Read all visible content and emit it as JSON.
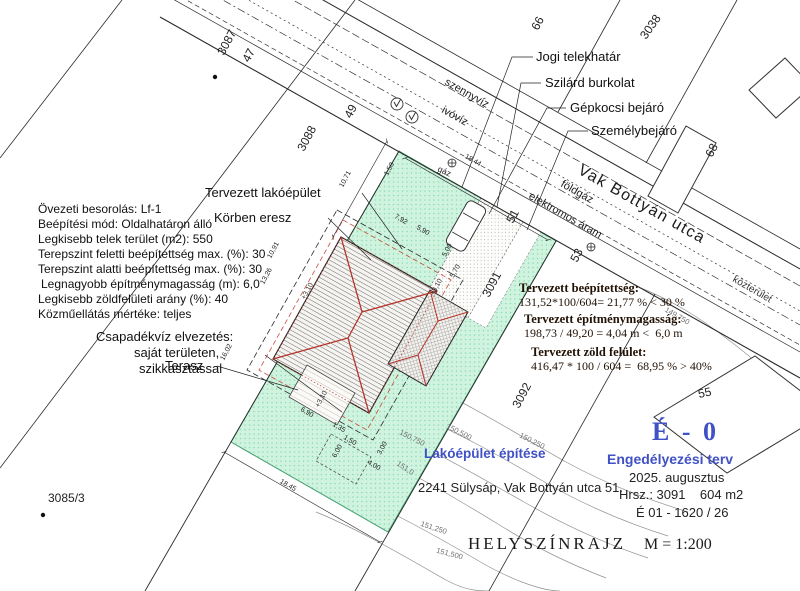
{
  "colors": {
    "plot_green": "#cff3de",
    "green_dot": "#8adbb0",
    "ridge_red": "#b5332a",
    "accent_blue": "#3f51c4",
    "date_blue": "#7c8ce0",
    "ink": "#1c1c1c"
  },
  "street": {
    "name": "Vak Bottyán utca",
    "kozterulet": "közterület"
  },
  "utilities": {
    "szennyviz": "szennyvíz",
    "ivoviz": "ivóvíz",
    "foldgaz": "földgáz",
    "elektromos": "elektromos áram",
    "gaz": "gáz"
  },
  "legend_leaders": {
    "jogi": "Jogi telekhatár",
    "szilard": "Szilárd burkolat",
    "gepkocsi": "Gépkocsi bejáró",
    "szemely": "Személybejáró"
  },
  "zoning_lines": [
    "Övezeti besorolás:  Lf-1",
    "Beépítési mód: Oldalhatáron álló",
    "Legkisebb telek terület (m2): 550",
    "Terepszint feletti beépítettség max. (%): 30",
    "Terepszint alatti beépítettség max. (%): 30",
    "Legnagyobb építménymagasság (m): 6,0",
    "Legkisebb zöldfelületi arány (%): 40",
    "Közműellátás mértéke: teljes"
  ],
  "drainage": {
    "l1": "Csapadékvíz elvezetés:",
    "l2": "saját területen,",
    "l3": "szikkasztással"
  },
  "house": {
    "lakoepulet": "Tervezett lakóépület",
    "eresz": "Körben eresz",
    "terasz": "Terasz"
  },
  "calc": {
    "t1": "Tervezett beépítettség:",
    "v1": "131,52*100/604= 21,77 % < 30 %",
    "t2": "Tervezett építménymagasság:",
    "v2": "198,73 / 49,20 = 4,04 m <  6,0 m",
    "t3": "Tervezett zöld felület:",
    "v3": "416,47 * 100 / 604 =  68,95 % > 40%"
  },
  "title_block": {
    "sheet": "É - 0",
    "project": "Lakóépület építése",
    "address": "2241 Sülysáp, Vak Bottyán utca 51.",
    "doc": "Engedélyezési terv",
    "date": "2025. augusztus",
    "hrsz": "Hrsz.: 3091    604 m2",
    "ref": "É 01 - 1620 / 26",
    "map_title": "HELYSZÍNRAJZ",
    "scale": "M = 1:200"
  },
  "parcels": {
    "p3087": "3087",
    "p3088": "3088",
    "p3091": "3091",
    "p3092": "3092",
    "p3038": "3038",
    "p3085": "3085/3",
    "n47": "47",
    "n49": "49",
    "n51": "51",
    "n53": "53",
    "n55": "55",
    "n66": "66",
    "n68": "68"
  },
  "contours": [
    "149,750",
    "150,250",
    "150,500",
    "150,750",
    "151,0",
    "151,250",
    "151,500"
  ],
  "dims": {
    "top": "18,44",
    "bottom": "18,45",
    "left": "10,71",
    "gate": "1,50",
    "west_a": "10,91",
    "west_b": "13,26",
    "west_c": "16,02",
    "t1": "7,92",
    "t2": "5,90",
    "r1": "5,00",
    "r2": "5,70",
    "b1": "6,90",
    "b2": "1,35",
    "b3": "6,00",
    "b4": "3,00",
    "b5": "4,00",
    "b6": "1,50",
    "lvl": "+3,10"
  }
}
